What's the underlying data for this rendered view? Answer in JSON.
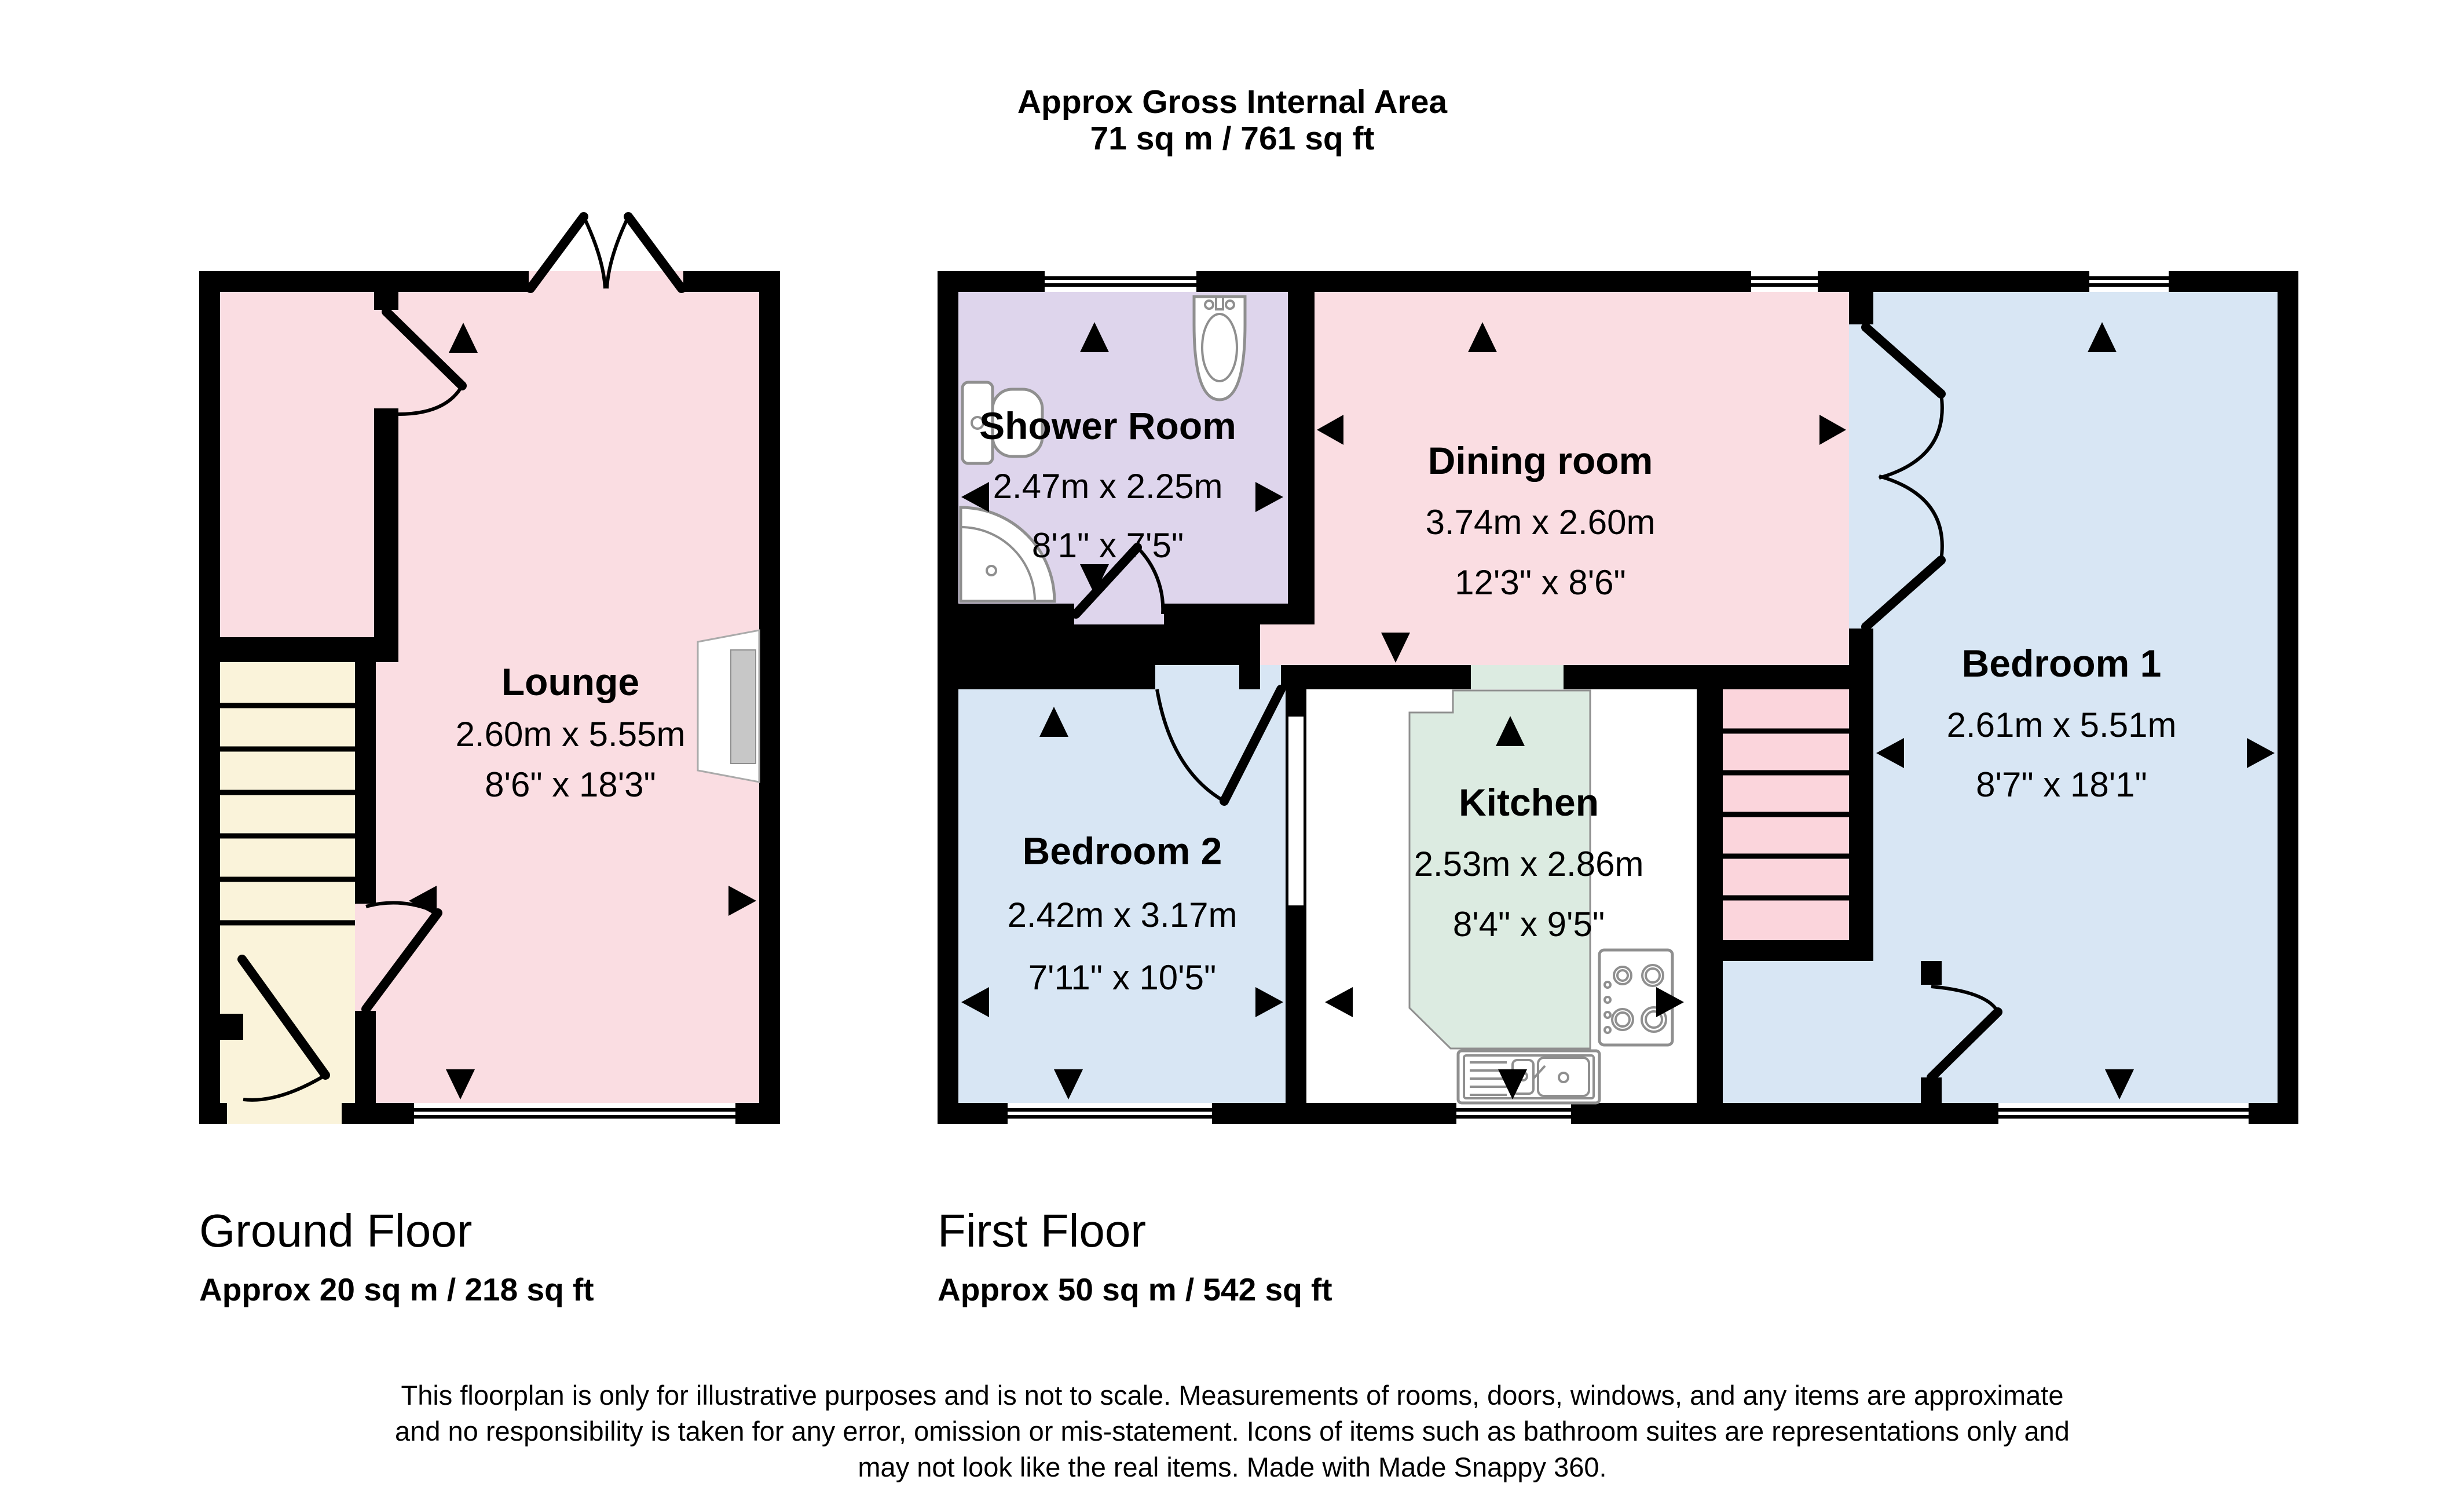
{
  "title": {
    "line1": "Approx Gross Internal Area",
    "line2": "71 sq m / 761 sq ft"
  },
  "ground_floor": {
    "name": "Ground Floor",
    "area": "Approx 20 sq m / 218 sq ft",
    "rooms": [
      {
        "name": "Lounge",
        "metric": "2.60m x 5.55m",
        "imperial": "8'6\" x 18'3\""
      }
    ]
  },
  "first_floor": {
    "name": "First Floor",
    "area": "Approx 50 sq m / 542 sq ft",
    "rooms": [
      {
        "name": "Shower Room",
        "metric": "2.47m x 2.25m",
        "imperial": "8'1\" x 7'5\""
      },
      {
        "name": "Dining room",
        "metric": "3.74m x 2.60m",
        "imperial": "12'3\" x 8'6\""
      },
      {
        "name": "Bedroom 1",
        "metric": "2.61m x 5.51m",
        "imperial": "8'7\" x 18'1\""
      },
      {
        "name": "Bedroom 2",
        "metric": "2.42m x 3.17m",
        "imperial": "7'11\" x 10'5\""
      },
      {
        "name": "Kitchen",
        "metric": "2.53m x 2.86m",
        "imperial": "8'4\" x 9'5\""
      }
    ]
  },
  "disclaimer": {
    "line1": "This floorplan is only for illustrative purposes and is not to scale. Measurements of rooms, doors, windows, and any items are approximate",
    "line2": "and no responsibility is taken for any error, omission or mis-statement. Icons of items such as bathroom suites are representations only and",
    "line3": "may not look like the real items. Made with Made Snappy 360."
  },
  "icons": {
    "bathroom": [
      "toilet-icon",
      "basin-icon",
      "corner-shower-icon"
    ],
    "kitchen": [
      "hob-icon",
      "kitchen-sink-icon"
    ],
    "symbols": [
      "door-swing",
      "window-symbol",
      "stairs",
      "direction-arrow"
    ]
  },
  "colors": {
    "wall": "#000000",
    "pink_room": "#fadde2",
    "lavender_room": "#ded5ec",
    "blue_room": "#d8e6f4",
    "green_room": "#dcebe1",
    "stairs_cream": "#faf3da",
    "stairs_pink": "#fbd5dc",
    "icon_outline": "#8f8f8f",
    "recess_gray": "#c7c7c7"
  }
}
